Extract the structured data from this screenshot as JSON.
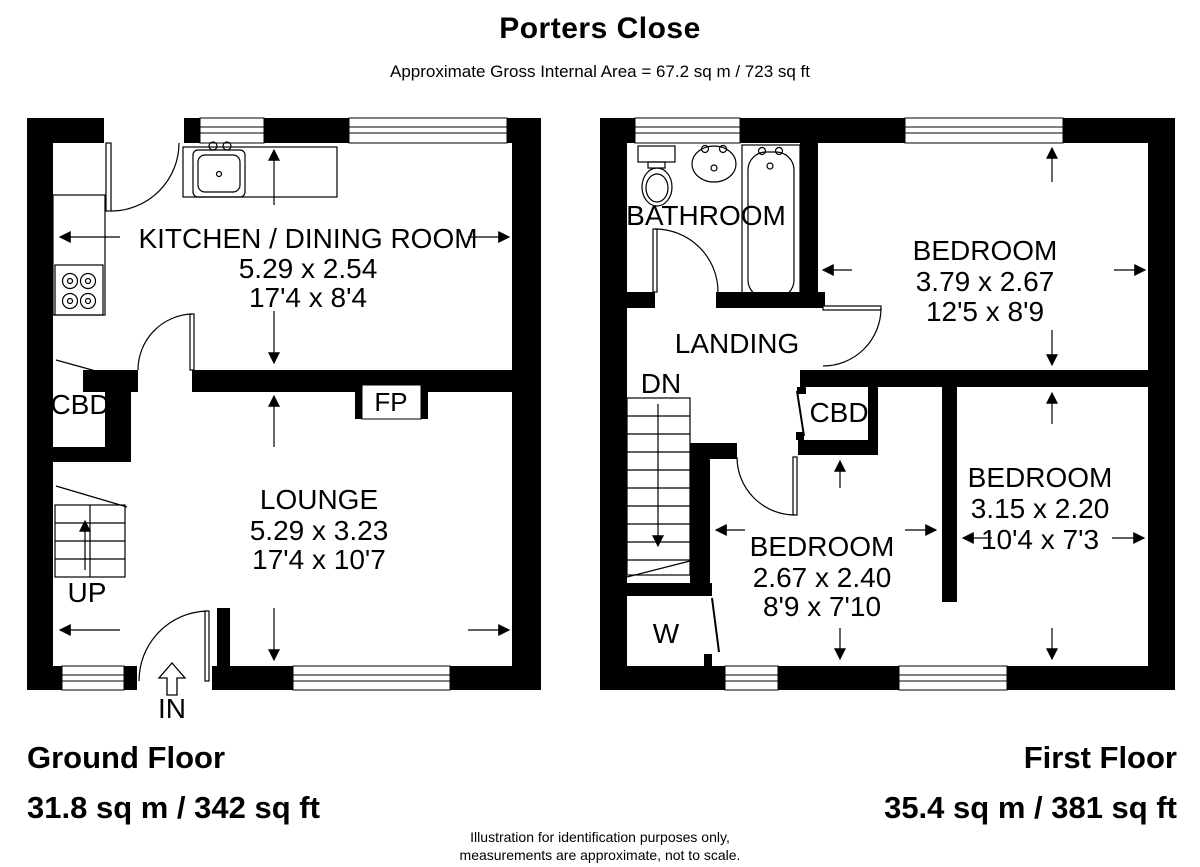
{
  "header": {
    "title": "Porters Close",
    "subtitle": "Approximate Gross Internal Area =  67.2 sq m / 723 sq ft"
  },
  "ground_floor": {
    "name_label": "Ground Floor",
    "area_label": "31.8 sq m / 342 sq ft",
    "rooms": {
      "kitchen": {
        "name": "KITCHEN / DINING ROOM",
        "metric": "5.29 x 2.54",
        "imperial": "17'4 x 8'4"
      },
      "lounge": {
        "name": "LOUNGE",
        "metric": "5.29 x 3.23",
        "imperial": "17'4 x 10'7"
      }
    },
    "labels": {
      "cbd": "CBD",
      "fp": "FP",
      "up": "UP",
      "in": "IN"
    }
  },
  "first_floor": {
    "name_label": "First Floor",
    "area_label": "35.4 sq m / 381 sq ft",
    "rooms": {
      "bathroom": {
        "name": "BATHROOM"
      },
      "bedroom1": {
        "name": "BEDROOM",
        "metric": "3.79 x 2.67",
        "imperial": "12'5 x 8'9"
      },
      "bedroom2": {
        "name": "BEDROOM",
        "metric": "3.15 x 2.20",
        "imperial": "10'4 x 7'3"
      },
      "bedroom3": {
        "name": "BEDROOM",
        "metric": "2.67 x 2.40",
        "imperial": "8'9 x 7'10"
      },
      "landing": {
        "name": "LANDING"
      }
    },
    "labels": {
      "dn": "DN",
      "cbd": "CBD",
      "w": "W"
    }
  },
  "footer": {
    "line1": "Illustration for identification purposes only,",
    "line2": "measurements are approximate, not to scale."
  },
  "colors": {
    "wall": "#000000",
    "background": "#ffffff",
    "line": "#000000"
  }
}
